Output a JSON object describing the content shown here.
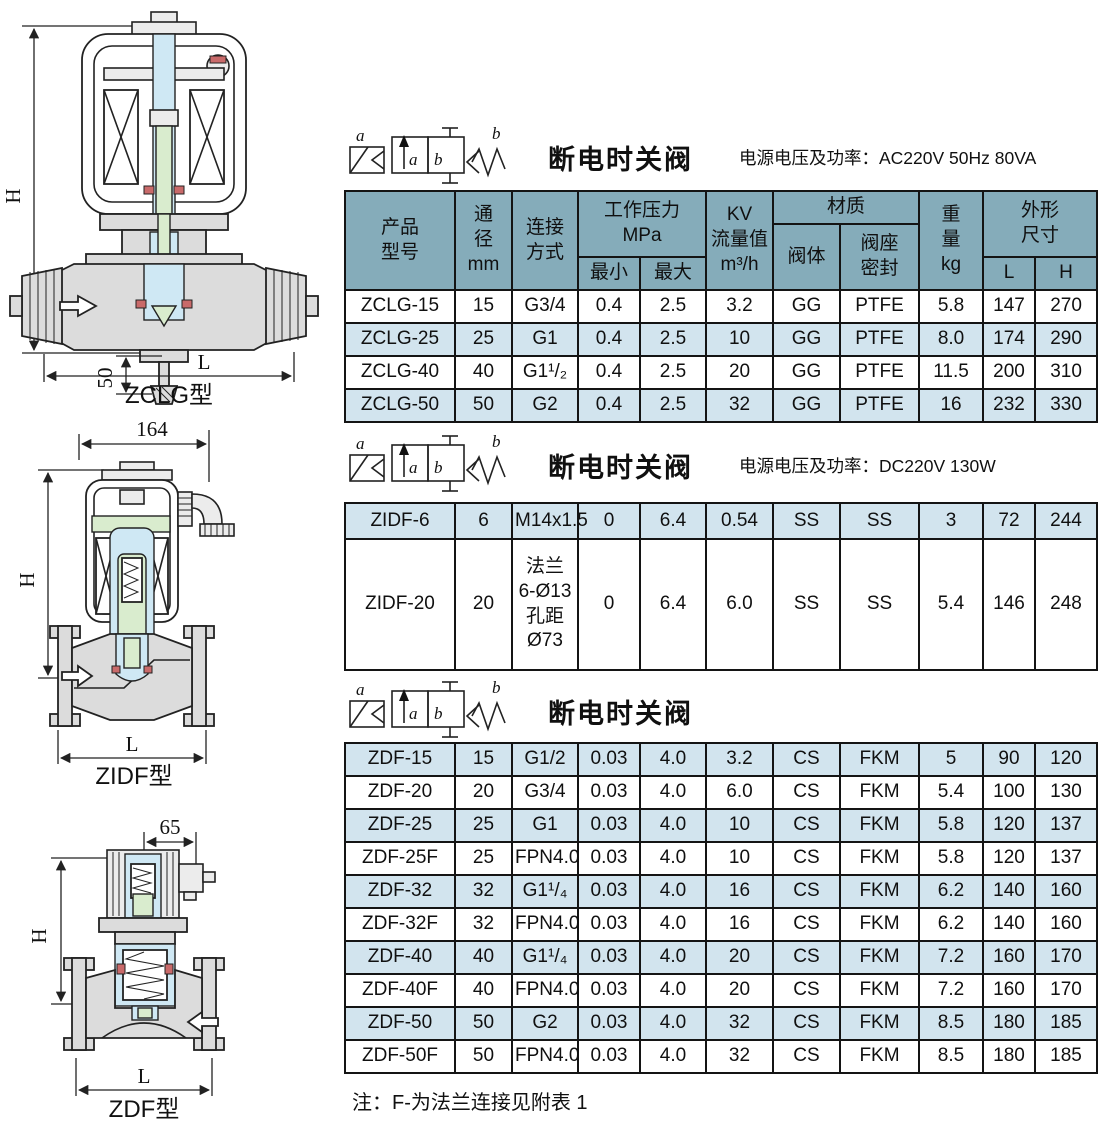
{
  "colors": {
    "header_bg": "#85acba",
    "row_alt": "#d2e4ee",
    "row_white": "#ffffff",
    "border": "#141414",
    "ink": "#101010",
    "drawing_body": "#dcdcdc",
    "drawing_light": "#ececec",
    "drawing_blue": "#cfe8f4",
    "drawing_green": "#d9ecce",
    "drawing_red": "#c96a6a"
  },
  "symbol": {
    "coil_label": "a",
    "spring_label": "b",
    "port_a": "a",
    "port_b": "b"
  },
  "sections": [
    {
      "title": "断电时关阀",
      "power": "电源电压及功率：AC220V  50Hz  80VA"
    },
    {
      "title": "断电时关阀",
      "power": "电源电压及功率：DC220V  130W"
    },
    {
      "title": "断电时关阀",
      "power": ""
    }
  ],
  "table_header": {
    "product": "产品\n型号",
    "bore": "通\n径\nmm",
    "connection": "连接\n方式",
    "working_pressure": "工作压力\nMPa",
    "min": "最小",
    "max": "最大",
    "kv": "KV\n流量值\nm³/h",
    "material": "材质",
    "valve_body": "阀体",
    "seat_seal": "阀座\n密封",
    "weight": "重\n量\nkg",
    "overall": "外形\n尺寸",
    "L": "L",
    "H": "H"
  },
  "tables": [
    {
      "rows": [
        {
          "shaded": false,
          "cells": [
            "ZCLG-15",
            "15",
            "G3/4",
            "0.4",
            "2.5",
            "3.2",
            "GG",
            "PTFE",
            "5.8",
            "147",
            "270"
          ]
        },
        {
          "shaded": true,
          "cells": [
            "ZCLG-25",
            "25",
            "G1",
            "0.4",
            "2.5",
            "10",
            "GG",
            "PTFE",
            "8.0",
            "174",
            "290"
          ]
        },
        {
          "shaded": false,
          "cells": [
            "ZCLG-40",
            "40",
            "G1¹/₂",
            "0.4",
            "2.5",
            "20",
            "GG",
            "PTFE",
            "11.5",
            "200",
            "310"
          ]
        },
        {
          "shaded": true,
          "cells": [
            "ZCLG-50",
            "50",
            "G2",
            "0.4",
            "2.5",
            "32",
            "GG",
            "PTFE",
            "16",
            "232",
            "330"
          ]
        }
      ]
    },
    {
      "rows": [
        {
          "shaded": true,
          "cells": [
            "ZIDF-6",
            "6",
            "M14x1.5",
            "0",
            "6.4",
            "0.54",
            "SS",
            "SS",
            "3",
            "72",
            "244"
          ]
        },
        {
          "shaded": false,
          "cells": [
            "ZIDF-20",
            "20",
            "法兰\n6-Ø13\n孔距\nØ73",
            "0",
            "6.4",
            "6.0",
            "SS",
            "SS",
            "5.4",
            "146",
            "248"
          ]
        }
      ]
    },
    {
      "rows": [
        {
          "shaded": true,
          "cells": [
            "ZDF-15",
            "15",
            "G1/2",
            "0.03",
            "4.0",
            "3.2",
            "CS",
            "FKM",
            "5",
            "90",
            "120"
          ]
        },
        {
          "shaded": false,
          "cells": [
            "ZDF-20",
            "20",
            "G3/4",
            "0.03",
            "4.0",
            "6.0",
            "CS",
            "FKM",
            "5.4",
            "100",
            "130"
          ]
        },
        {
          "shaded": true,
          "cells": [
            "ZDF-25",
            "25",
            "G1",
            "0.03",
            "4.0",
            "10",
            "CS",
            "FKM",
            "5.8",
            "120",
            "137"
          ]
        },
        {
          "shaded": false,
          "cells": [
            "ZDF-25F",
            "25",
            "FPN4.0",
            "0.03",
            "4.0",
            "10",
            "CS",
            "FKM",
            "5.8",
            "120",
            "137"
          ]
        },
        {
          "shaded": true,
          "cells": [
            "ZDF-32",
            "32",
            "G1¹/₄",
            "0.03",
            "4.0",
            "16",
            "CS",
            "FKM",
            "6.2",
            "140",
            "160"
          ]
        },
        {
          "shaded": false,
          "cells": [
            "ZDF-32F",
            "32",
            "FPN4.0",
            "0.03",
            "4.0",
            "16",
            "CS",
            "FKM",
            "6.2",
            "140",
            "160"
          ]
        },
        {
          "shaded": true,
          "cells": [
            "ZDF-40",
            "40",
            "G1¹/₄",
            "0.03",
            "4.0",
            "20",
            "CS",
            "FKM",
            "7.2",
            "160",
            "170"
          ]
        },
        {
          "shaded": false,
          "cells": [
            "ZDF-40F",
            "40",
            "FPN4.0",
            "0.03",
            "4.0",
            "20",
            "CS",
            "FKM",
            "7.2",
            "160",
            "170"
          ]
        },
        {
          "shaded": true,
          "cells": [
            "ZDF-50",
            "50",
            "G2",
            "0.03",
            "4.0",
            "32",
            "CS",
            "FKM",
            "8.5",
            "180",
            "185"
          ]
        },
        {
          "shaded": false,
          "cells": [
            "ZDF-50F",
            "50",
            "FPN4.0",
            "0.03",
            "4.0",
            "32",
            "CS",
            "FKM",
            "8.5",
            "180",
            "185"
          ]
        }
      ]
    }
  ],
  "note": "注：F-为法兰连接见附表 1",
  "diagrams": [
    {
      "label": "ZCLG型",
      "dim_height": "H",
      "dim_length": "L",
      "dim_small": "50"
    },
    {
      "label": "ZIDF型",
      "dim_height": "H",
      "dim_length": "L",
      "dim_top": "164"
    },
    {
      "label": "ZDF型",
      "dim_height": "H",
      "dim_length": "L",
      "dim_top": "65"
    }
  ]
}
